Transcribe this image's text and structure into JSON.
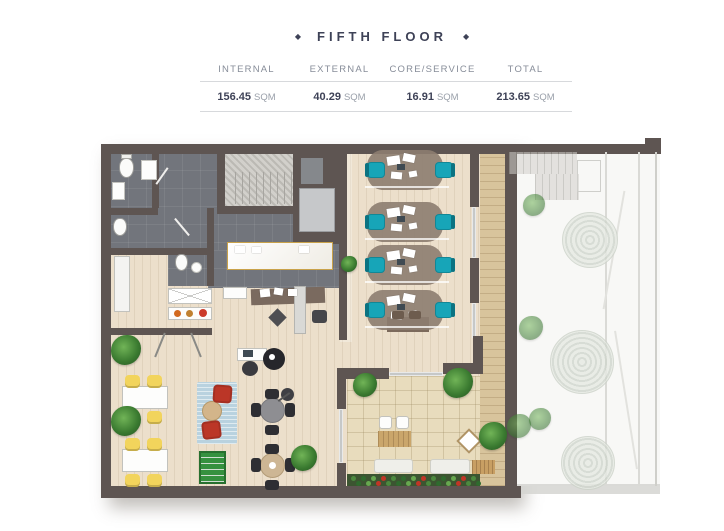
{
  "theme": {
    "ink": "#3e4257",
    "mute": "#878d99"
  },
  "header": {
    "diamond": "◆",
    "title": "FIFTH FLOOR"
  },
  "stats": {
    "columns": [
      {
        "label": "INTERNAL",
        "value": "156.45",
        "unit": "SQM"
      },
      {
        "label": "EXTERNAL",
        "value": "40.29",
        "unit": "SQM"
      },
      {
        "label": "CORE/SERVICE",
        "value": "16.91",
        "unit": "SQM"
      },
      {
        "label": "TOTAL",
        "value": "213.65",
        "unit": "SQM"
      }
    ]
  },
  "plan": {
    "colors": {
      "wall": "#5e5552",
      "tile": "#72757c",
      "wood": "#ecdfcb",
      "deck": "#d8c49c",
      "stone": "#e8dcbd",
      "courtyard": "#f8f8f6",
      "teal": "#17a5b8",
      "tealDark": "#0b7382",
      "yellow": "#f2d45c",
      "red": "#bb3627",
      "rug": "#b9d2df",
      "marbleBorder": "#c9a24a",
      "mat": "#8d7d70"
    },
    "desk_area": {
      "x": 272,
      "w": 76,
      "h": 40,
      "rows": [
        40,
        92,
        135,
        180
      ]
    },
    "teal_chairs": [
      [
        272,
        32,
        "L"
      ],
      [
        340,
        32,
        "R"
      ],
      [
        272,
        84,
        "L"
      ],
      [
        340,
        84,
        "R"
      ],
      [
        272,
        127,
        "L"
      ],
      [
        340,
        127,
        "R"
      ],
      [
        272,
        172,
        "L"
      ],
      [
        340,
        172,
        "R"
      ]
    ],
    "yellow_chairs": [
      [
        30,
        245
      ],
      [
        52,
        245
      ],
      [
        30,
        281
      ],
      [
        52,
        281
      ],
      [
        30,
        308
      ],
      [
        52,
        308
      ],
      [
        30,
        344
      ],
      [
        52,
        344
      ]
    ],
    "black_chairs": [
      [
        170,
        259,
        14,
        10
      ],
      [
        170,
        295,
        14,
        10
      ],
      [
        156,
        273,
        10,
        14
      ],
      [
        190,
        273,
        10,
        14
      ],
      [
        170,
        314,
        14,
        10
      ],
      [
        170,
        350,
        14,
        10
      ],
      [
        156,
        328,
        10,
        14
      ],
      [
        190,
        328,
        10,
        14
      ]
    ],
    "brown_chairs": [
      [
        297,
        181,
        12,
        8
      ],
      [
        314,
        181,
        12,
        8
      ]
    ],
    "plants": [
      [
        16,
        205,
        30
      ],
      [
        16,
        276,
        30
      ],
      [
        196,
        315,
        26
      ],
      [
        246,
        126,
        16
      ],
      [
        348,
        238,
        30
      ],
      [
        384,
        292,
        28
      ],
      [
        258,
        243,
        24
      ]
    ],
    "trees": [
      [
        467,
        82,
        56
      ],
      [
        455,
        200,
        64
      ],
      [
        466,
        306,
        54
      ]
    ],
    "court_plants": [
      [
        428,
        64,
        22
      ],
      [
        424,
        186,
        24
      ],
      [
        434,
        278,
        22
      ],
      [
        412,
        284,
        24
      ]
    ],
    "papers": [
      [
        165,
        159,
        10,
        8,
        -6
      ],
      [
        179,
        158,
        9,
        7,
        9
      ],
      [
        193,
        159,
        9,
        7,
        0
      ],
      [
        140,
        116,
        10,
        7,
        0
      ],
      [
        157,
        117,
        9,
        6,
        0
      ],
      [
        204,
        116,
        10,
        7,
        0
      ]
    ],
    "desk_papers": [
      [
        20,
        6,
        13,
        9,
        -8
      ],
      [
        36,
        4,
        12,
        8,
        12
      ],
      [
        24,
        22,
        11,
        7,
        5
      ],
      [
        42,
        21,
        8,
        6,
        -10
      ]
    ],
    "flower_bed": {
      "x0": 256,
      "y0": 346,
      "cols": 13,
      "step": 10,
      "rows": 2,
      "palette": [
        "#4c8a3f",
        "#2f6b2e",
        "#67a84f",
        "#c13526"
      ]
    }
  }
}
